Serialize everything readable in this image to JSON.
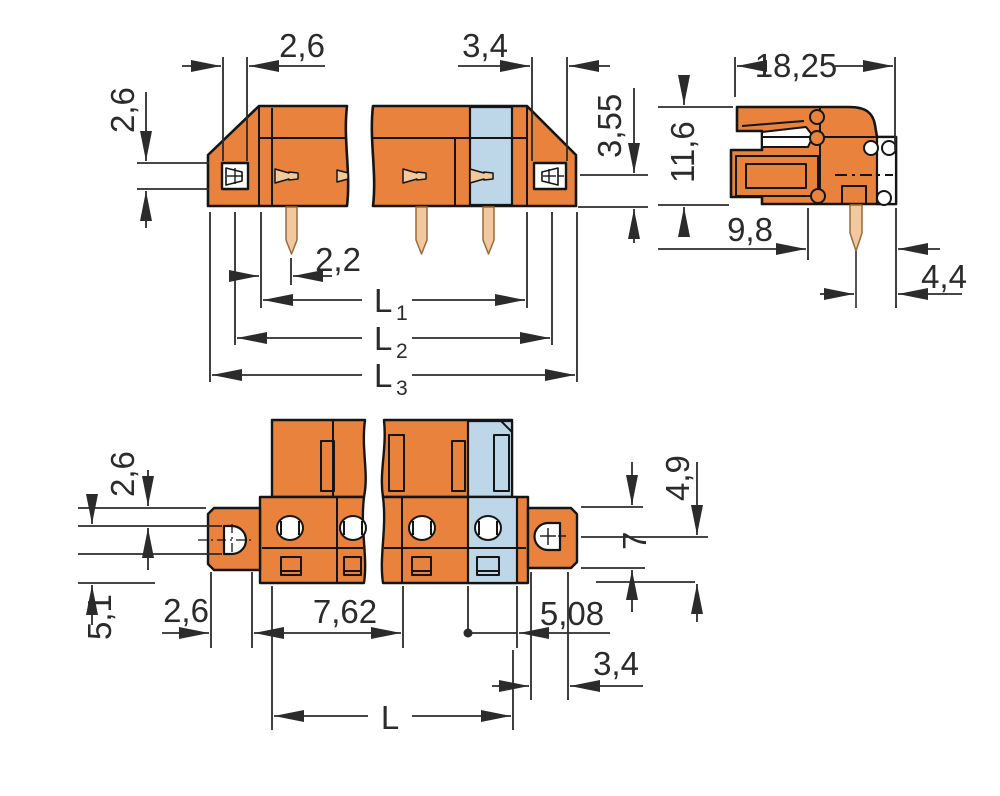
{
  "drawing": {
    "type": "technical-dimension-drawing",
    "subject": "PCB terminal block / female connector with solder pins and mounting flanges",
    "views": [
      "front-view",
      "side-view",
      "bottom-view"
    ],
    "colors": {
      "housing_orange": "#E8823C",
      "end_pole_blue": "#BDD7E8",
      "pin_tan": "#F2C89E",
      "outline": "#151515",
      "dimension_line": "#2b2b2b",
      "background": "#ffffff"
    },
    "dims": {
      "front_window_width": "2,6",
      "front_right_window_width": "3,4",
      "front_contact_to_bottom": "3,55",
      "front_window_height": "2,6",
      "front_pin_offset": "2,2",
      "L1": {
        "base": "L",
        "sub": "1"
      },
      "L2": {
        "base": "L",
        "sub": "2"
      },
      "L3": {
        "base": "L",
        "sub": "3"
      },
      "side_width": "18,25",
      "side_height": "11,6",
      "side_depth": "9,8",
      "side_pin_to_edge": "4,4",
      "bottom_flange_top": "2,6",
      "bottom_flange_side": "5,1",
      "bottom_flange_left_width": "2,6",
      "bottom_pitch": "7,62",
      "bottom_last_pole": "5,08",
      "bottom_flange_right_width": "3,4",
      "bottom_hole_to_edge": "4,9",
      "bottom_flange_width": "7",
      "bottom_length": "L"
    },
    "symbols": {
      "plus_mark": "+",
      "minus_mark": "−"
    }
  }
}
